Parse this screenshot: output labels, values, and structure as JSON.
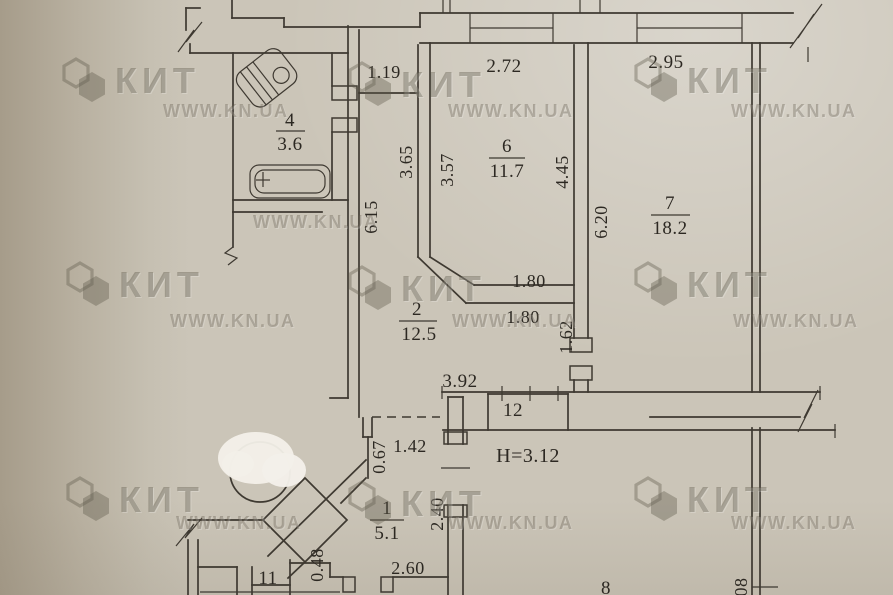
{
  "watermark": {
    "brand": "КИТ",
    "site": "WWW.KN.UA"
  },
  "ceiling_height": "H=3.12",
  "rooms": [
    {
      "number": "4",
      "area": "3.6"
    },
    {
      "number": "6",
      "area": "11.7"
    },
    {
      "number": "7",
      "area": "18.2"
    },
    {
      "number": "2",
      "area": "12.5"
    },
    {
      "number": "1",
      "area": "5.1"
    },
    {
      "number": "12",
      "area": ""
    },
    {
      "number": "11",
      "area": ""
    },
    {
      "number": "8",
      "area": ""
    }
  ],
  "dimensions": [
    {
      "value": "1.19",
      "orientation": "horizontal"
    },
    {
      "value": "2.72",
      "orientation": "horizontal"
    },
    {
      "value": "2.95",
      "orientation": "horizontal"
    },
    {
      "value": "3.65",
      "orientation": "vertical"
    },
    {
      "value": "3.57",
      "orientation": "vertical"
    },
    {
      "value": "4.45",
      "orientation": "vertical"
    },
    {
      "value": "6.20",
      "orientation": "vertical"
    },
    {
      "value": "6.15",
      "orientation": "vertical"
    },
    {
      "value": "1.80",
      "orientation": "horizontal"
    },
    {
      "value": "1.80",
      "orientation": "horizontal"
    },
    {
      "value": "1.62",
      "orientation": "vertical"
    },
    {
      "value": "3.92",
      "orientation": "horizontal"
    },
    {
      "value": "1.42",
      "orientation": "horizontal"
    },
    {
      "value": "0.67",
      "orientation": "vertical"
    },
    {
      "value": "2.40",
      "orientation": "vertical"
    },
    {
      "value": "2.60",
      "orientation": "horizontal"
    },
    {
      "value": "0.48",
      "orientation": "vertical"
    },
    {
      "value": "08",
      "orientation": "vertical"
    }
  ],
  "colors": {
    "paper": "#cbc5b8",
    "line": "#3e3931",
    "text": "#2c2822",
    "watermark": "#6e675a",
    "glare": "#f3f0e9"
  }
}
